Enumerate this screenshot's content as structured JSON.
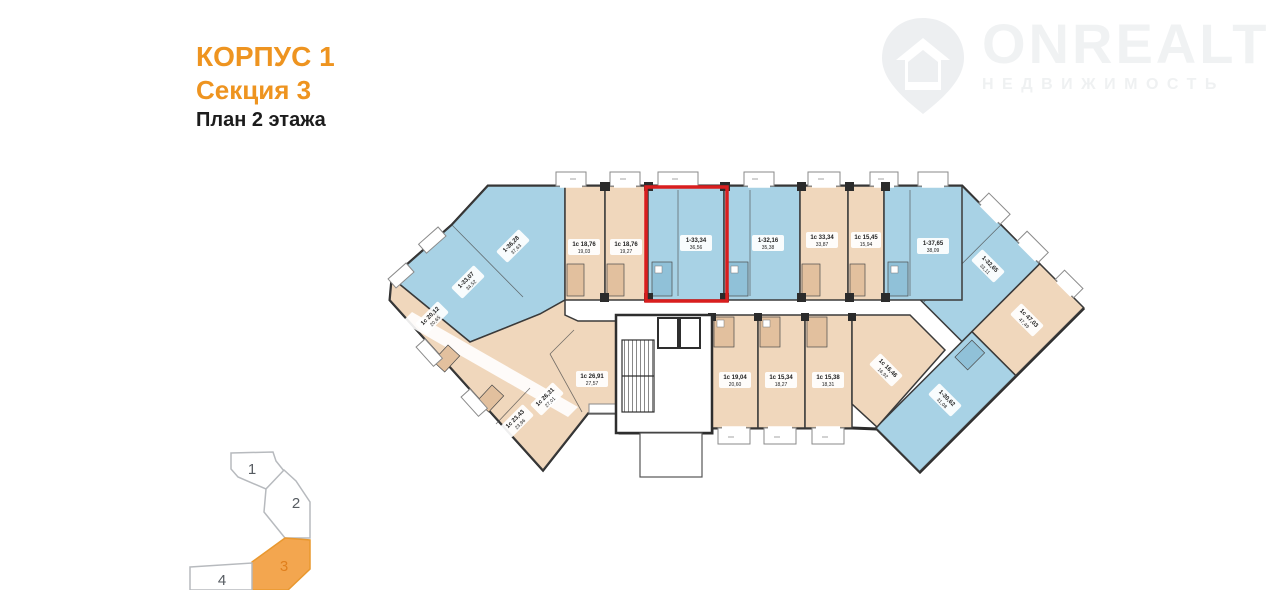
{
  "header": {
    "building": "КОРПУС 1",
    "section": "Секция 3",
    "floor": "План 2 этажа"
  },
  "watermark": {
    "brand": "ONREALT",
    "subtitle": "НЕДВИЖИМОСТЬ"
  },
  "colors": {
    "accent_orange": "#ee9420",
    "plan_blue": "#a8d2e5",
    "plan_peach": "#f0d7bc",
    "highlight_red": "#d91e1e",
    "wall": "#2b2b2b",
    "minimap_active": "#f3a64f",
    "watermark_gray": "#f0f2f3"
  },
  "plan": {
    "apartments": [
      {
        "id": "left-corner-top",
        "l1": "1-36,28",
        "l2": "37,63",
        "color": "blue",
        "highlighted": false
      },
      {
        "id": "left-corner-low",
        "l1": "1-33,07",
        "l2": "34,52",
        "color": "blue",
        "highlighted": false
      },
      {
        "id": "left-wing-upper",
        "l1": "1с 20,12",
        "l2": "20,65",
        "color": "peach",
        "highlighted": false
      },
      {
        "id": "left-wing-low-1",
        "l1": "1с 23,43",
        "l2": "23,96",
        "color": "peach",
        "highlighted": false
      },
      {
        "id": "left-wing-low-2",
        "l1": "1с 26,31",
        "l2": "27,01",
        "color": "peach",
        "highlighted": false
      },
      {
        "id": "left-wing-low-3",
        "l1": "1с 26,91",
        "l2": "27,57",
        "color": "peach",
        "highlighted": false
      },
      {
        "id": "top-row-1",
        "l1": "1с 18,76",
        "l2": "19,03",
        "color": "peach",
        "highlighted": false
      },
      {
        "id": "top-row-2",
        "l1": "1с 18,76",
        "l2": "19,27",
        "color": "peach",
        "highlighted": false
      },
      {
        "id": "top-row-3-selected",
        "l1": "1-33,34",
        "l2": "36,56",
        "color": "blue",
        "highlighted": true
      },
      {
        "id": "top-row-4",
        "l1": "1-32,16",
        "l2": "35,38",
        "color": "blue",
        "highlighted": false
      },
      {
        "id": "top-row-5",
        "l1": "1с 33,34",
        "l2": "33,87",
        "color": "peach",
        "highlighted": false
      },
      {
        "id": "top-row-6",
        "l1": "1с 15,45",
        "l2": "15,94",
        "color": "peach",
        "highlighted": false
      },
      {
        "id": "top-row-7",
        "l1": "1-37,65",
        "l2": "38,09",
        "color": "blue",
        "highlighted": false
      },
      {
        "id": "right-wing-upper",
        "l1": "1-32,65",
        "l2": "33,11",
        "color": "blue",
        "highlighted": false
      },
      {
        "id": "right-wing-strip",
        "l1": "1с 47,03",
        "l2": "47,49",
        "color": "peach",
        "highlighted": false
      },
      {
        "id": "right-wing-tip",
        "l1": "1-30,62",
        "l2": "31,08",
        "color": "blue",
        "highlighted": false
      },
      {
        "id": "bottom-row-1",
        "l1": "1с 19,04",
        "l2": "20,60",
        "color": "peach",
        "highlighted": false
      },
      {
        "id": "bottom-row-2",
        "l1": "1с 15,34",
        "l2": "18,27",
        "color": "peach",
        "highlighted": false
      },
      {
        "id": "bottom-row-3",
        "l1": "1с 15,38",
        "l2": "18,31",
        "color": "peach",
        "highlighted": false
      },
      {
        "id": "bottom-row-4",
        "l1": "1с 16,46",
        "l2": "16,92",
        "color": "peach",
        "highlighted": false
      }
    ]
  },
  "minimap": {
    "sections": [
      {
        "label": "1",
        "active": false
      },
      {
        "label": "2",
        "active": false
      },
      {
        "label": "3",
        "active": true
      },
      {
        "label": "4",
        "active": false
      }
    ]
  }
}
